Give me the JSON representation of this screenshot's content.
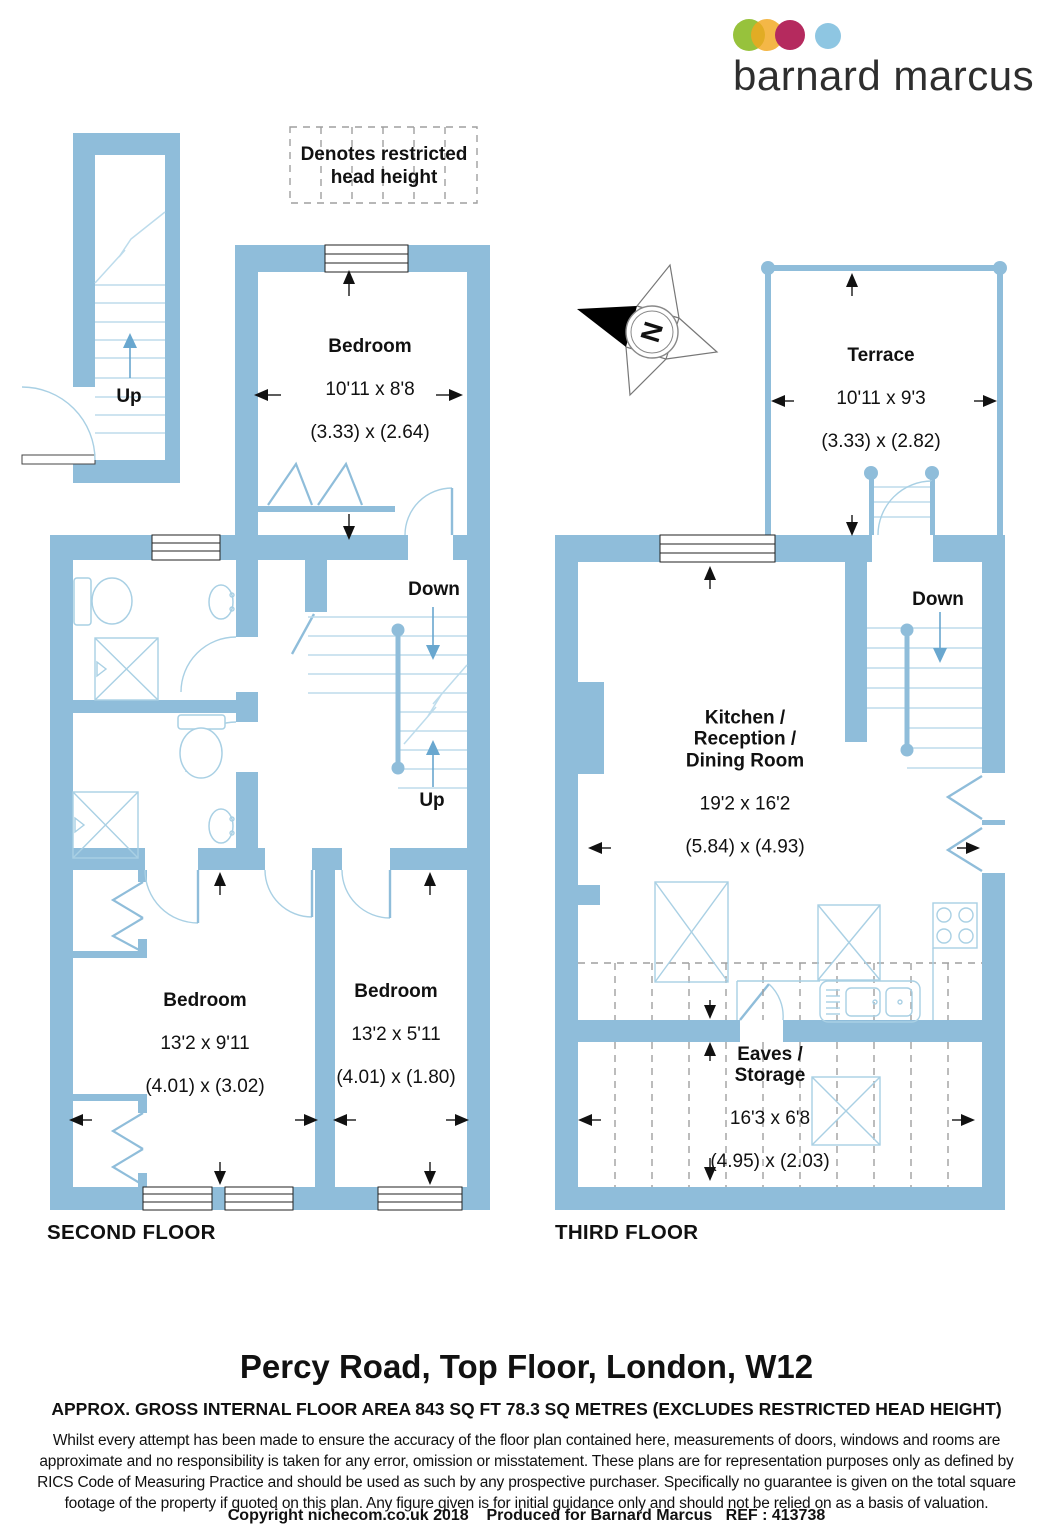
{
  "brand": {
    "name": "barnard marcus",
    "dot_colors": [
      "#97c23c",
      "#f2a71e",
      "#b52a5e",
      "#8ec6e2"
    ]
  },
  "legend": {
    "text": "Denotes restricted\nhead height"
  },
  "compass": {
    "north_label": "N"
  },
  "second_floor": {
    "label": "SECOND FLOOR",
    "stair_up_hall": "Up",
    "landing_down": "Down",
    "landing_up": "Up",
    "bedroom_top": {
      "name": "Bedroom",
      "imperial": "10'11 x 8'8",
      "metric": "(3.33) x (2.64)"
    },
    "bedroom_left": {
      "name": "Bedroom",
      "imperial": "13'2 x 9'11",
      "metric": "(4.01) x (3.02)"
    },
    "bedroom_right": {
      "name": "Bedroom",
      "imperial": "13'2 x 5'11",
      "metric": "(4.01) x (1.80)"
    }
  },
  "third_floor": {
    "label": "THIRD FLOOR",
    "stair_down": "Down",
    "terrace": {
      "name": "Terrace",
      "imperial": "10'11 x 9'3",
      "metric": "(3.33) x (2.82)"
    },
    "kitchen": {
      "name": "Kitchen /\nReception /\nDining Room",
      "imperial": "19'2 x 16'2",
      "metric": "(5.84) x (4.93)"
    },
    "eaves": {
      "name": "Eaves /\nStorage",
      "imperial": "16'3 x 6'8",
      "metric": "(4.95) x (2.03)"
    }
  },
  "footer": {
    "title": "Percy Road, Top Floor, London, W12",
    "area_line": "APPROX. GROSS INTERNAL FLOOR AREA 843 SQ FT 78.3 SQ METRES (EXCLUDES RESTRICTED HEAD HEIGHT)",
    "disclaimer": "Whilst every attempt has been made to ensure the accuracy of the floor plan contained here, measurements of doors, windows and rooms are approximate and no responsibility is taken for any error, omission or misstatement. These plans are for representation purposes only as defined by RICS Code of Measuring Practice and should be used as such by any prospective purchaser.  Specifically no guarantee is given on the total square footage of the property if quoted on this plan. Any figure given is for initial guidance only and should not be relied on as a basis of valuation.",
    "copyright": "Copyright nichecom.co.uk 2018    Produced for Barnard Marcus   REF : 413738"
  },
  "colors": {
    "wall": "#8fbdda",
    "fixture_line": "#a9d0e4",
    "stair_arrow": "#69a7cf",
    "dashed_line": "#9f9f9f"
  }
}
